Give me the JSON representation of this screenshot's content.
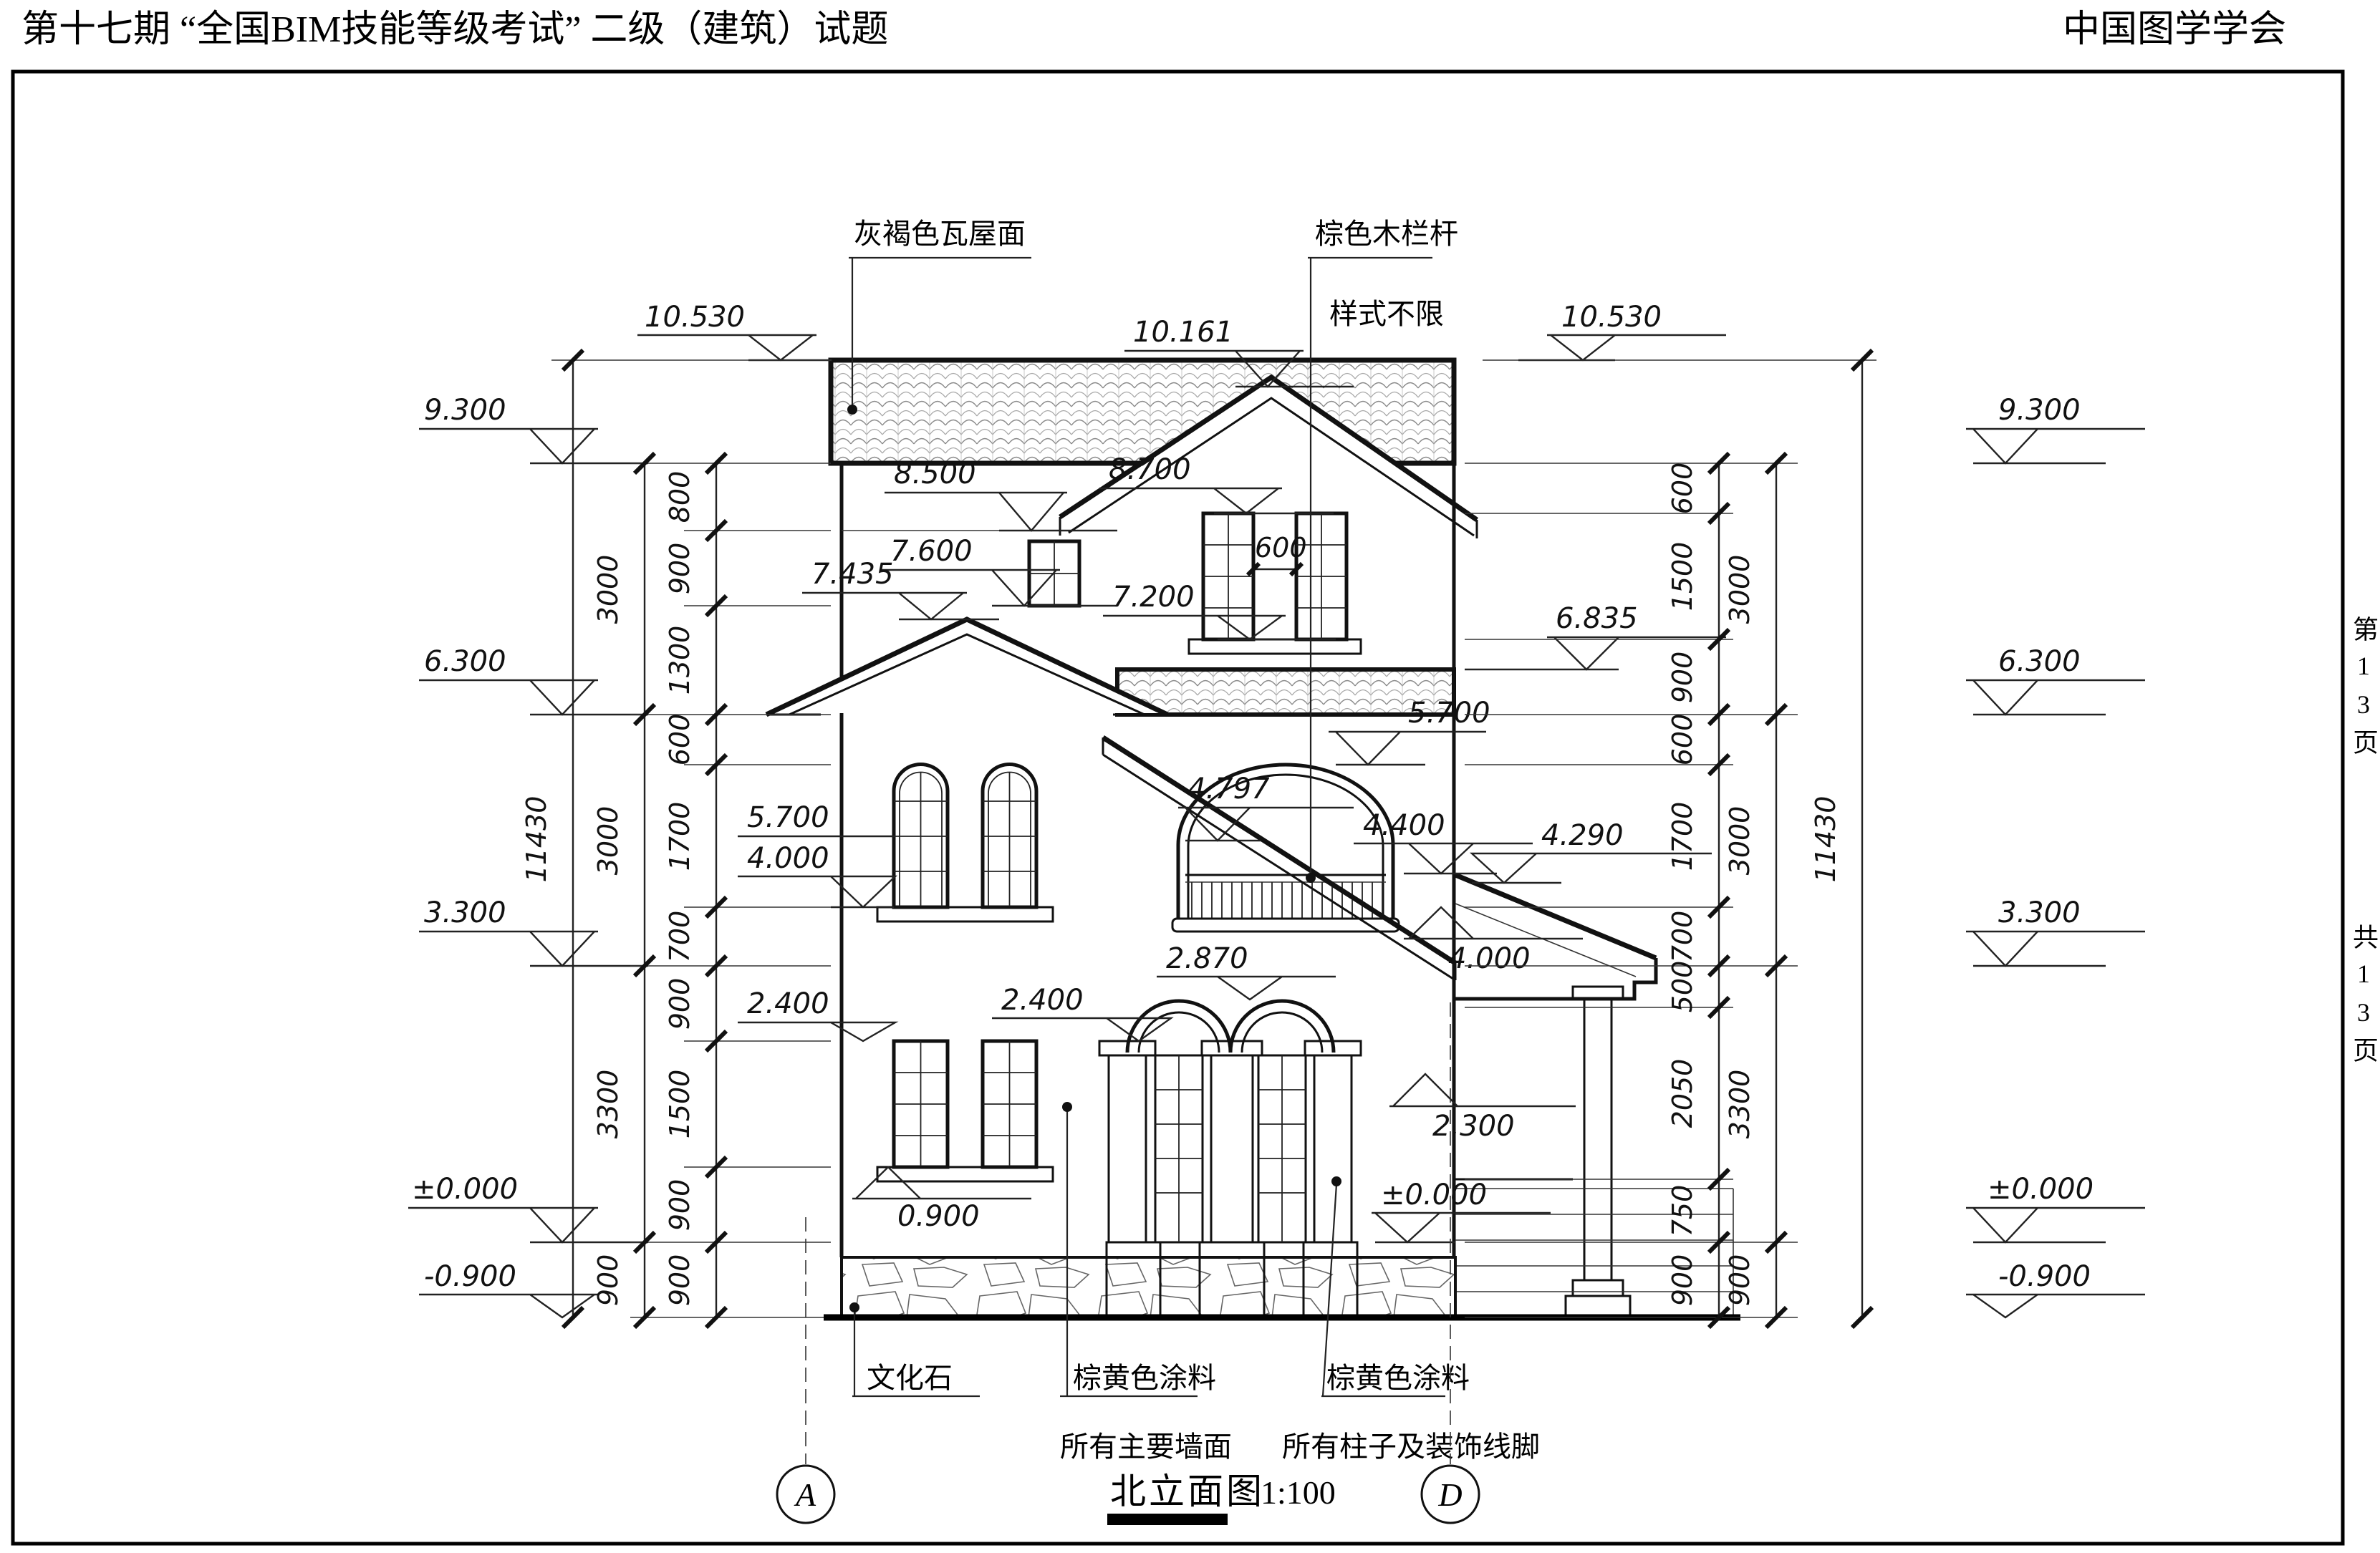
{
  "header": {
    "title_left": "第十七期 “全国BIM技能等级考试” 二级（建筑）试题",
    "title_right": "中国图学学会"
  },
  "margin": {
    "page_current": "第13页",
    "page_total": "共13页"
  },
  "drawing_title": {
    "name": "北立面图",
    "scale": "1:100"
  },
  "grid": {
    "left_bubble": "A",
    "right_bubble": "D"
  },
  "notes": {
    "roof": "灰褐色瓦屋面",
    "railing_line1": "棕色木栏杆",
    "railing_line2": "样式不限",
    "stone": "文化石",
    "paint_wall_line1": "棕黄色涂料",
    "paint_wall_line2": "所有主要墙面",
    "paint_col_line1": "棕黄色涂料",
    "paint_col_line2": "所有柱子及装饰线脚"
  },
  "levels": {
    "left": [
      "10.530",
      "9.300",
      "6.300",
      "3.300",
      "±0.000",
      "-0.900"
    ],
    "right": [
      "10.530",
      "9.300",
      "6.300",
      "3.300",
      "±0.000",
      "-0.900"
    ],
    "v10161": "10.161",
    "v8500": "8.500",
    "v8700": "8.700",
    "v7600": "7.600",
    "v7435": "7.435",
    "v7200": "7.200",
    "v6835": "6.835",
    "v5700l": "5.700",
    "v4000l": "4.000",
    "v2400l": "2.400",
    "v0900": "0.900",
    "v4797": "4.797",
    "v5700c": "5.700",
    "v4400": "4.400",
    "v4290": "4.290",
    "v4000c": "4.000",
    "v2870": "2.870",
    "v2400c": "2.400",
    "v2300": "2.300",
    "v0000c": "±0.000",
    "win_gap": "600"
  },
  "dims": {
    "left_inner": [
      "800",
      "900",
      "1300",
      "600",
      "1700",
      "700",
      "900",
      "1500",
      "900",
      "900"
    ],
    "left_outer": [
      "3000",
      "3000",
      "3300",
      "900"
    ],
    "left_total": "11430",
    "right_inner": [
      "600",
      "1500",
      "900",
      "600",
      "1700",
      "700",
      "500",
      "2050",
      "750",
      "900"
    ],
    "right_outer": [
      "3000",
      "3000",
      "3300",
      "900"
    ],
    "right_total": "11430"
  }
}
